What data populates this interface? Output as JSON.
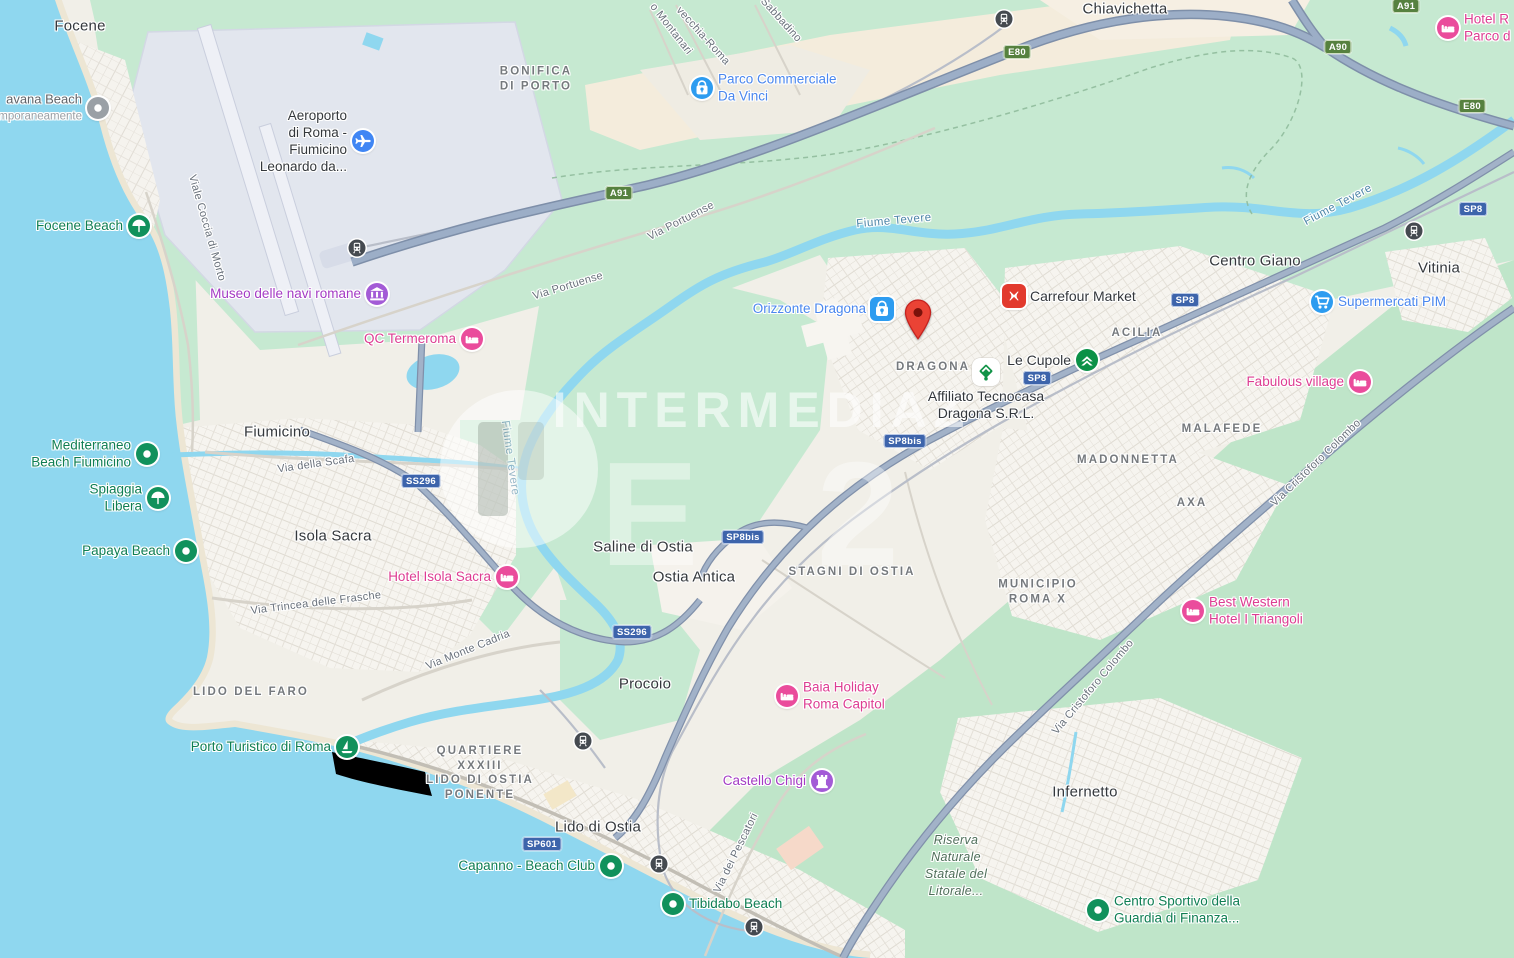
{
  "watermark": {
    "text": "INTERMEDIAZ",
    "big": "E2"
  },
  "colors": {
    "water": "#8fd7ef",
    "land": "#f1efe8",
    "green": "#c6e9d1",
    "urban": "#f6f4ef",
    "beige": "#f3ebdb",
    "airport": "#e3e6ee",
    "motorway": "#9caec7",
    "shield_green": "#56813f",
    "shield_blue": "#3d64ab",
    "poi_green": "#11915c",
    "poi_pink": "#ea4c9c",
    "poi_purple": "#a35bd6",
    "poi_blue": "#2d9cf0",
    "marker_red": "#EA4335",
    "carrefour_red": "#e23a2e",
    "tecnocasa_green": "#119347"
  },
  "labels": {
    "localities": [
      {
        "t": "Focene",
        "x": 80,
        "y": 26
      },
      {
        "t": "Chiavichetta",
        "x": 1125,
        "y": 9
      },
      {
        "t": "Fiumicino",
        "x": 277,
        "y": 432
      },
      {
        "t": "Isola Sacra",
        "x": 333,
        "y": 536
      },
      {
        "t": "Saline di Ostia",
        "x": 643,
        "y": 547
      },
      {
        "t": "Ostia Antica",
        "x": 694,
        "y": 577
      },
      {
        "t": "Procoio",
        "x": 645,
        "y": 684
      },
      {
        "t": "Lido di Ostia",
        "x": 598,
        "y": 827
      },
      {
        "t": "Centro Giano",
        "x": 1255,
        "y": 261
      },
      {
        "t": "Vitinia",
        "x": 1439,
        "y": 268
      },
      {
        "t": "Infernetto",
        "x": 1085,
        "y": 792
      }
    ],
    "areas": [
      {
        "lines": [
          "BONIFICA",
          "DI PORTO"
        ],
        "x": 536,
        "y": 79
      },
      {
        "lines": [
          "DRAGONA"
        ],
        "x": 933,
        "y": 367
      },
      {
        "lines": [
          "ACILIA"
        ],
        "x": 1137,
        "y": 333
      },
      {
        "lines": [
          "MALAFEDE"
        ],
        "x": 1222,
        "y": 429
      },
      {
        "lines": [
          "MADONNETTA"
        ],
        "x": 1128,
        "y": 460
      },
      {
        "lines": [
          "AXA"
        ],
        "x": 1192,
        "y": 503
      },
      {
        "lines": [
          "MUNICIPIO",
          "ROMA X"
        ],
        "x": 1038,
        "y": 592
      },
      {
        "lines": [
          "LIDO DEL FARO"
        ],
        "x": 251,
        "y": 692
      },
      {
        "lines": [
          "QUARTIERE",
          "XXXIII",
          "LIDO DI OSTIA",
          "PONENTE"
        ],
        "x": 480,
        "y": 773
      },
      {
        "lines": [
          "STAGNI DI OSTIA"
        ],
        "x": 852,
        "y": 572
      },
      {
        "lines": [
          "Riserva",
          "Naturale",
          "Statale del",
          "Litorale..."
        ],
        "x": 956,
        "y": 866,
        "style": "nat"
      }
    ],
    "roads": [
      {
        "t": "Viale Coccia di Morto",
        "x": 207,
        "y": 228,
        "r": 74
      },
      {
        "t": "Via Portuense",
        "x": 681,
        "y": 221,
        "r": -27
      },
      {
        "t": "Via Portuense",
        "x": 568,
        "y": 286,
        "r": -17
      },
      {
        "t": "o Montanari",
        "x": 671,
        "y": 29,
        "r": 52
      },
      {
        "t": "vecchia-Roma",
        "x": 703,
        "y": 36,
        "r": 48
      },
      {
        "t": "Sabbadino",
        "x": 781,
        "y": 20,
        "r": 48
      },
      {
        "t": "Via della Scafa",
        "x": 316,
        "y": 464,
        "r": -8
      },
      {
        "t": "Via Trincea delle Frasche",
        "x": 316,
        "y": 603,
        "r": -7
      },
      {
        "t": "Via Monte Cadria",
        "x": 468,
        "y": 650,
        "r": -22
      },
      {
        "t": "Via dei Pescatori",
        "x": 736,
        "y": 853,
        "r": -64
      },
      {
        "t": "Via Cristoforo Colombo",
        "x": 1316,
        "y": 463,
        "r": -44
      },
      {
        "t": "Via Cristoforo Colombo",
        "x": 1093,
        "y": 687,
        "r": -50
      }
    ],
    "rivers": [
      {
        "t": "Fiume Tevere",
        "x": 894,
        "y": 221,
        "r": -5
      },
      {
        "t": "Fiume Tevere",
        "x": 1338,
        "y": 205,
        "r": -28
      },
      {
        "t": "Fiume Tevere",
        "x": 510,
        "y": 458,
        "r": 82,
        "faded": true
      }
    ],
    "shields": [
      {
        "t": "A91",
        "c": "green",
        "x": 619,
        "y": 193
      },
      {
        "t": "E80",
        "c": "green",
        "x": 1017,
        "y": 52
      },
      {
        "t": "A91",
        "c": "green",
        "x": 1406,
        "y": 6
      },
      {
        "t": "A90",
        "c": "green",
        "x": 1338,
        "y": 47
      },
      {
        "t": "E80",
        "c": "green",
        "x": 1472,
        "y": 106
      },
      {
        "t": "SP8",
        "c": "blue",
        "x": 1185,
        "y": 300
      },
      {
        "t": "SP8",
        "c": "blue",
        "x": 1037,
        "y": 378
      },
      {
        "t": "SP8",
        "c": "blue",
        "x": 1473,
        "y": 209
      },
      {
        "t": "SP8bis",
        "c": "blue",
        "x": 905,
        "y": 441
      },
      {
        "t": "SP8bis",
        "c": "blue",
        "x": 743,
        "y": 537
      },
      {
        "t": "SS296",
        "c": "blue",
        "x": 421,
        "y": 481
      },
      {
        "t": "SS296",
        "c": "blue",
        "x": 632,
        "y": 632
      },
      {
        "t": "SP601",
        "c": "blue",
        "x": 542,
        "y": 844
      }
    ]
  },
  "pois": [
    {
      "lines": [
        "Focene Beach"
      ],
      "cls": "green",
      "icon": "umbrella",
      "ix": 139,
      "iy": 226,
      "side": "left"
    },
    {
      "lines": [
        "Mediterraneo",
        "Beach Fiumicino"
      ],
      "cls": "green",
      "icon": "dot",
      "ix": 147,
      "iy": 454,
      "side": "left"
    },
    {
      "lines": [
        "Spiaggia",
        "Libera"
      ],
      "cls": "green",
      "icon": "umbrella",
      "ix": 158,
      "iy": 498,
      "side": "left"
    },
    {
      "lines": [
        "Papaya Beach"
      ],
      "cls": "green",
      "icon": "dot",
      "ix": 186,
      "iy": 551,
      "side": "left"
    },
    {
      "lines": [
        "Porto Turistico di Roma"
      ],
      "cls": "green",
      "icon": "marina",
      "ix": 347,
      "iy": 747,
      "side": "left"
    },
    {
      "lines": [
        "Capanno - Beach Club"
      ],
      "cls": "green",
      "icon": "dot",
      "ix": 611,
      "iy": 866,
      "side": "left"
    },
    {
      "lines": [
        "Tibidabo Beach"
      ],
      "cls": "green",
      "icon": "dot",
      "ix": 673,
      "iy": 904,
      "side": "right"
    },
    {
      "lines": [
        "Centro Sportivo della",
        "Guardia di Finanza..."
      ],
      "cls": "green",
      "icon": "dot",
      "ix": 1098,
      "iy": 910,
      "side": "right"
    },
    {
      "lines": [
        "QC Termeroma"
      ],
      "cls": "pink",
      "icon": "bed",
      "ix": 472,
      "iy": 339,
      "side": "left"
    },
    {
      "lines": [
        "Hotel Isola Sacra"
      ],
      "cls": "pink",
      "icon": "bed",
      "ix": 507,
      "iy": 577,
      "side": "left"
    },
    {
      "lines": [
        "Fabulous village"
      ],
      "cls": "pink",
      "icon": "bed",
      "ix": 1360,
      "iy": 382,
      "side": "left"
    },
    {
      "lines": [
        "Best Western",
        "Hotel I Triangoli"
      ],
      "cls": "pink",
      "icon": "bed",
      "ix": 1193,
      "iy": 611,
      "side": "right"
    },
    {
      "lines": [
        "Baia Holiday",
        "Roma Capitol"
      ],
      "cls": "pink",
      "icon": "bed",
      "ix": 787,
      "iy": 696,
      "side": "right"
    },
    {
      "lines": [
        "Hotel R",
        "Parco d"
      ],
      "cls": "pink",
      "icon": "bed",
      "ix": 1448,
      "iy": 28,
      "side": "right"
    },
    {
      "lines": [
        "Museo delle navi romane"
      ],
      "cls": "purple",
      "icon": "museum",
      "ix": 377,
      "iy": 294,
      "side": "left"
    },
    {
      "lines": [
        "Castello Chigi"
      ],
      "cls": "purple",
      "icon": "castle",
      "ix": 822,
      "iy": 781,
      "side": "left"
    },
    {
      "lines": [
        "Parco Commerciale",
        "Da Vinci"
      ],
      "cls": "blue",
      "icon": "bag",
      "ix": 702,
      "iy": 88,
      "side": "right"
    },
    {
      "lines": [
        "Orizzonte Dragona"
      ],
      "cls": "blue",
      "icon": "bag",
      "sq": true,
      "ix": 882,
      "iy": 309,
      "side": "left"
    },
    {
      "lines": [
        "Supermercati PIM"
      ],
      "cls": "blue",
      "icon": "cart",
      "ix": 1322,
      "iy": 302,
      "side": "right"
    },
    {
      "lines": [
        "Carrefour Market"
      ],
      "cls": "dark",
      "icon": "carrefour",
      "sq": true,
      "ix": 1014,
      "iy": 296,
      "side": "right"
    },
    {
      "lines": [
        "Le Cupole"
      ],
      "cls": "dark",
      "icon": "lecupole",
      "ix": 1087,
      "iy": 360,
      "side": "left"
    },
    {
      "lines": [
        "Affiliato Tecnocasa",
        "Dragona S.R.L."
      ],
      "cls": "dark",
      "icon": "tecnocasa",
      "sq": true,
      "ix": 986,
      "iy": 372,
      "side": "below"
    },
    {
      "lines": [
        "avana Beach",
        "mporaneamente"
      ],
      "cls": "gray",
      "icon": "dot",
      "ix": 98,
      "iy": 108,
      "side": "left"
    },
    {
      "lines": [
        "Aeroporto",
        "di Roma -",
        "Fiumicino",
        "Leonardo da..."
      ],
      "cls": "locality",
      "icon": "plane",
      "ix": 363,
      "iy": 141,
      "side": "left"
    }
  ],
  "stations": [
    {
      "x": 1004,
      "y": 19
    },
    {
      "x": 357,
      "y": 248
    },
    {
      "x": 1414,
      "y": 231
    },
    {
      "x": 659,
      "y": 864
    },
    {
      "x": 754,
      "y": 927
    },
    {
      "x": 583,
      "y": 741
    }
  ],
  "marker": {
    "x": 918,
    "y": 320
  }
}
